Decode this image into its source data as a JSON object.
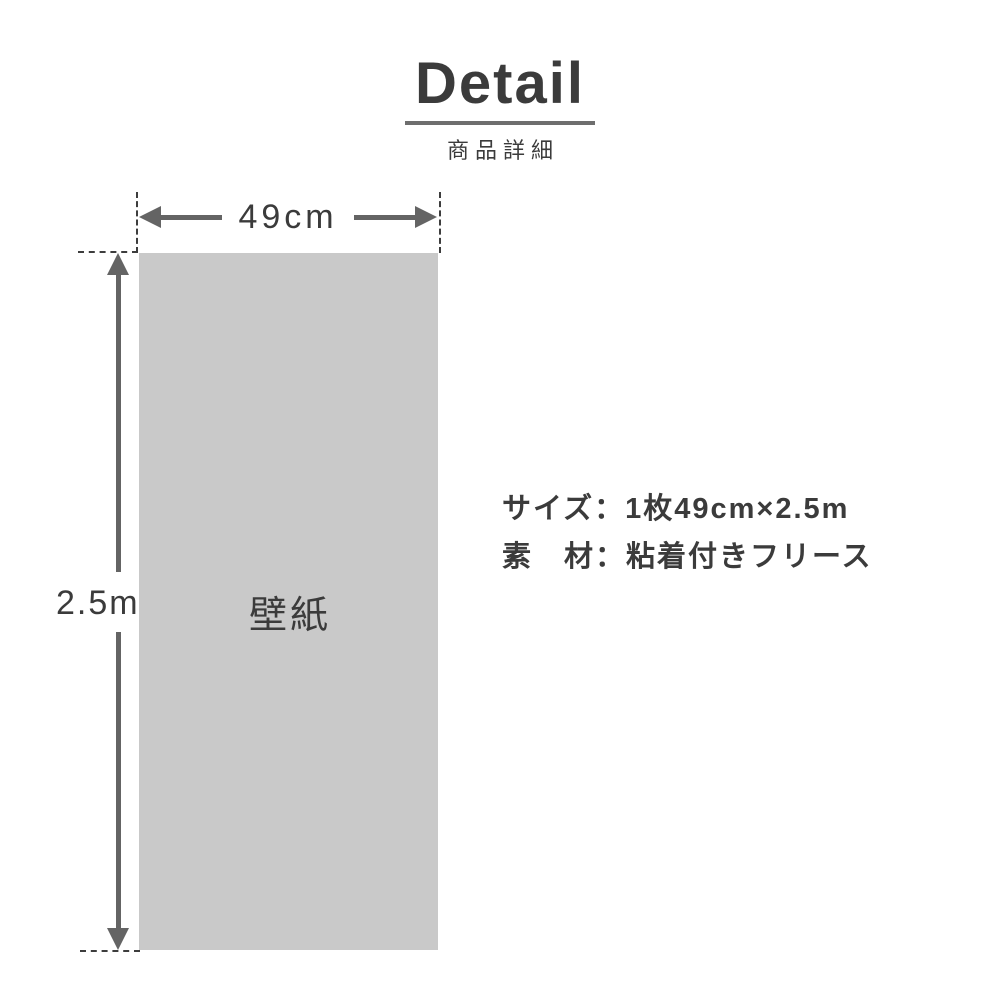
{
  "header": {
    "title": "Detail",
    "subtitle": "商品詳細"
  },
  "diagram": {
    "width_label": "49cm",
    "height_label": "2.5m",
    "panel_label": "壁紙"
  },
  "specs": {
    "size_line": "サイズ：1枚49cm×2.5m",
    "material_line": "素　材：粘着付きフリース"
  },
  "colors": {
    "panel_fill": "#c9c9c9",
    "arrow": "#646464",
    "dash": "#3d3d3d",
    "text": "#3b3b3b",
    "underline": "#6e6e6e"
  }
}
